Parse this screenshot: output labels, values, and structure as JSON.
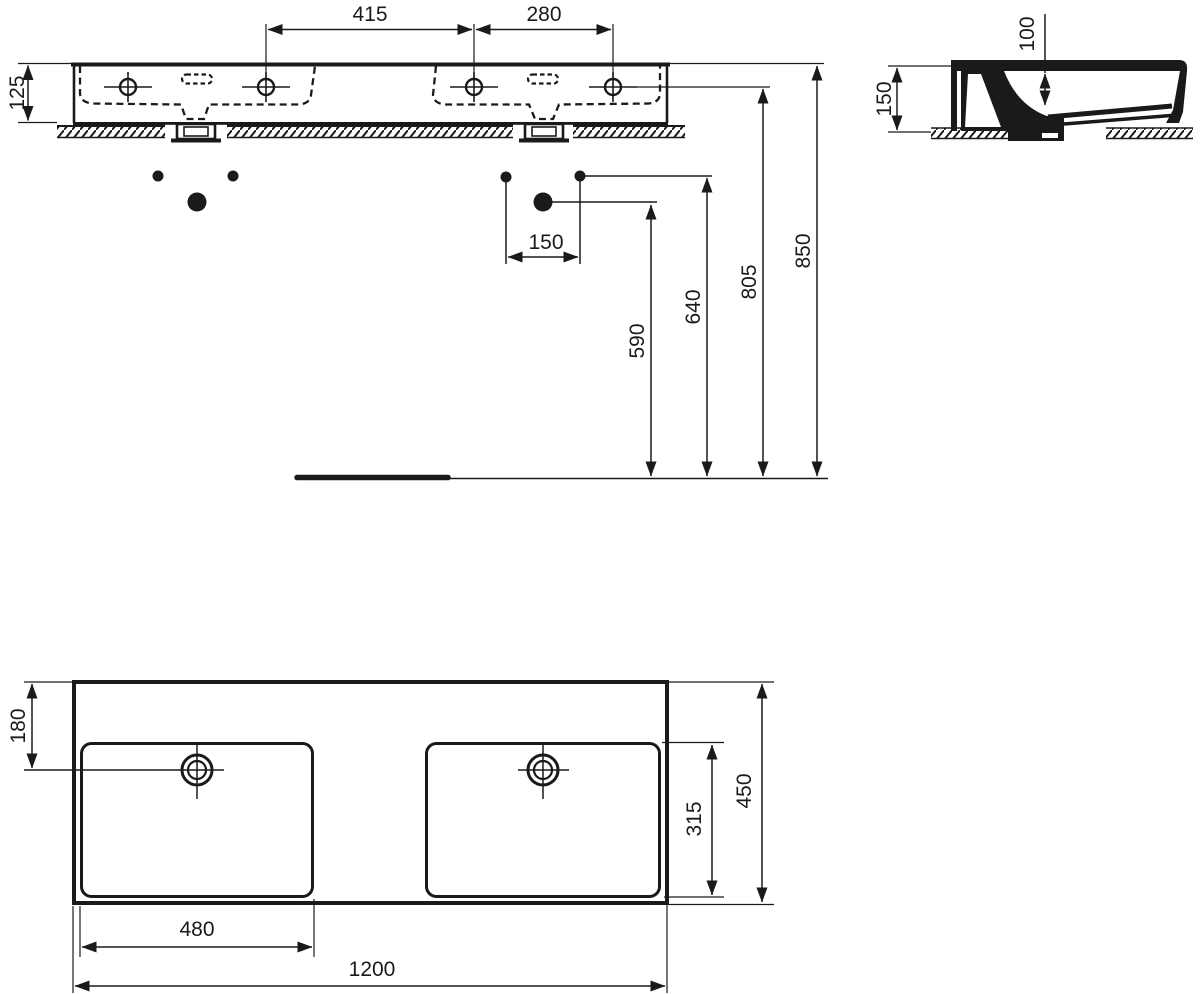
{
  "drawing": {
    "views": {
      "front": {
        "dims": {
          "tap_hole_spacing_left": "415",
          "tap_hole_spacing_right": "280",
          "basin_height": "125"
        }
      },
      "side": {
        "dims": {
          "overall_height": "150",
          "bowl_inner_depth": "100"
        }
      },
      "installation": {
        "dims": {
          "fixing_hole_spacing": "150",
          "rim_height_from_floor": "850",
          "tap_deck_height_from_floor": "805",
          "upper_fixing_height": "640",
          "lower_fixing_height": "590"
        }
      },
      "plan": {
        "dims": {
          "tap_centre_setback": "180",
          "bowl_front_to_back": "315",
          "overall_depth": "450",
          "bowl_width": "480",
          "overall_width": "1200"
        }
      }
    },
    "line_color": "#1a1a1a",
    "background_color": "#ffffff"
  }
}
